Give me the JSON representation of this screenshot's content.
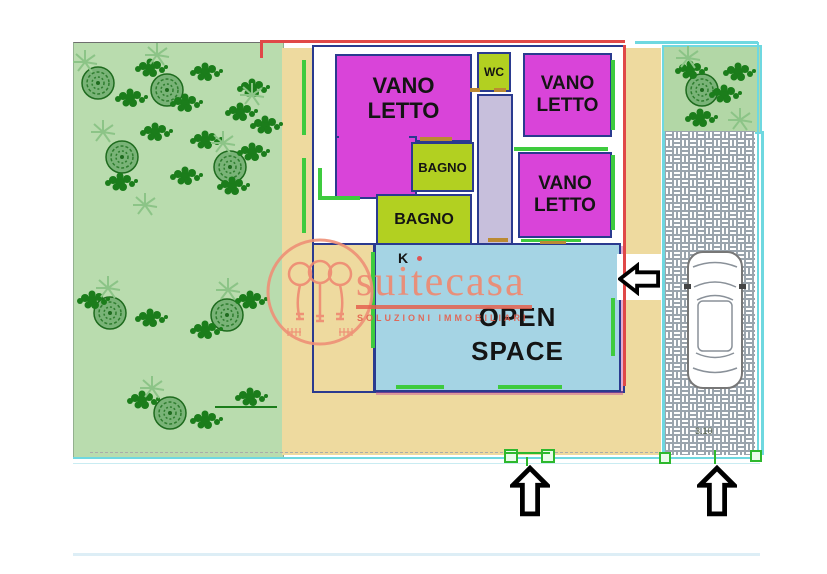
{
  "plan": {
    "rooms": {
      "bedroom_top_left": "VANO LETTO",
      "wc": "WC",
      "bedroom_top_right": "VANO LETTO",
      "bathroom_upper": "BAGNO",
      "bathroom_lower": "BAGNO",
      "bedroom_right": "VANO LETTO",
      "open_space": "OPEN SPACE",
      "kitchen": "K"
    },
    "dimension_label": "3.10",
    "colors": {
      "bedroom": "#d944d9",
      "bathroom": "#b2d021",
      "open_space": "#a5d4e4",
      "corridor": "#c7bfdc",
      "terrace": "#eeda9f",
      "garden": "#b9dcae",
      "wall": "#2a3a8f",
      "accent_red": "#e04848",
      "window_green": "#3ecb3e",
      "fence_cyan": "#6fd8e0",
      "watermark": "#ee8a72"
    }
  },
  "watermark": {
    "brand": "suitecasa",
    "tagline": "SOLUZIONI IMMOBILIARI"
  }
}
